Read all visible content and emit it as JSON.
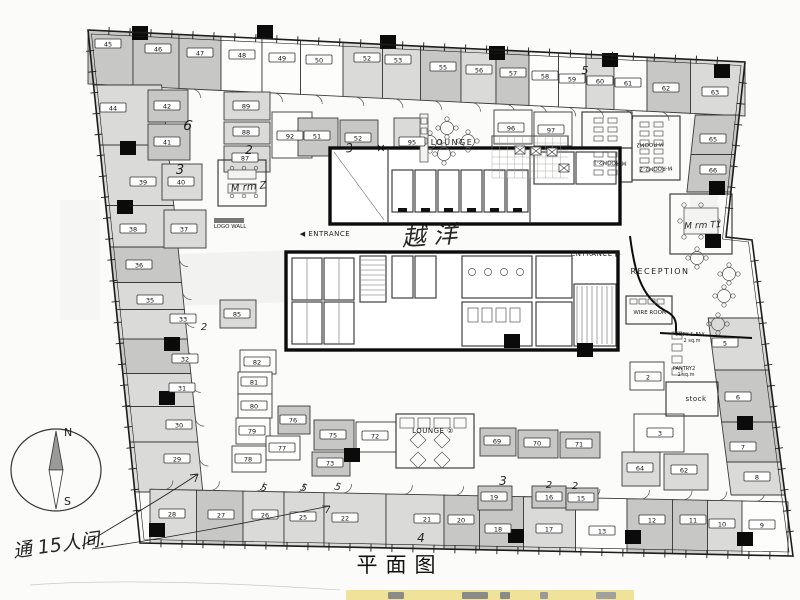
{
  "title": {
    "text": "平面图"
  },
  "compass": {
    "north": "N",
    "south": "S"
  },
  "colors": {
    "paper": "#fbfbf9",
    "wall": "#3a3a3a",
    "ink": "#1c1c1c",
    "gray_light": "#dadad8",
    "gray_mid": "#c7c7c5",
    "gray_dark": "#ababa9",
    "highlight": "#f0df8e"
  },
  "labels": [
    {
      "t": "LOUNGE",
      "x": 452,
      "y": 145,
      "s": 8,
      "ls": 1.5
    },
    {
      "t": "LOUNGE ②",
      "x": 433,
      "y": 433,
      "s": 7,
      "ls": 0.5
    },
    {
      "t": "RECEPTION",
      "x": 660,
      "y": 274,
      "s": 8,
      "ls": 1.5
    },
    {
      "t": "◀ ENTRANCE",
      "x": 325,
      "y": 236,
      "s": 7,
      "ls": 0.5
    },
    {
      "t": "ENTRANCE ▶",
      "x": 596,
      "y": 256,
      "s": 7,
      "ls": 0.5
    },
    {
      "t": "LOGO WALL",
      "x": 230,
      "y": 228,
      "s": 5.5,
      "ls": 0
    },
    {
      "t": "WIRE ROOM",
      "x": 650,
      "y": 314,
      "s": 5.5,
      "ls": 0
    },
    {
      "t": "COPY & FAX",
      "x": 690,
      "y": 336,
      "s": 5,
      "ls": 0
    },
    {
      "t": "2 sq.m",
      "x": 692,
      "y": 342,
      "s": 5,
      "ls": 0
    },
    {
      "t": "PANTRY2",
      "x": 684,
      "y": 370,
      "s": 5,
      "ls": 0
    },
    {
      "t": "1 sq.m",
      "x": 686,
      "y": 376,
      "s": 5,
      "ls": 0
    },
    {
      "t": "stock",
      "x": 696,
      "y": 401,
      "s": 7,
      "ls": 0.5
    },
    {
      "t": "M-ROOM2",
      "x": 650,
      "y": 143,
      "s": 5.5,
      "r": 178
    },
    {
      "t": "M-ROOM2-1",
      "x": 610,
      "y": 161,
      "s": 5.5,
      "r": 182
    },
    {
      "t": "M-ROOM2-2",
      "x": 656,
      "y": 167,
      "s": 5.5,
      "r": 178
    }
  ],
  "handwritten": [
    {
      "t": "越 洋",
      "x": 430,
      "y": 244,
      "s": 24,
      "r": -4
    },
    {
      "t": "M rm Z",
      "x": 249,
      "y": 190,
      "s": 10,
      "r": -6
    },
    {
      "t": "M rm T1",
      "x": 703,
      "y": 228,
      "s": 9,
      "r": -3
    },
    {
      "t": "通 15人间.",
      "x": 60,
      "y": 551,
      "s": 19,
      "r": -8
    },
    {
      "t": "6",
      "x": 187,
      "y": 130,
      "s": 14,
      "r": 10
    },
    {
      "t": "3",
      "x": 180,
      "y": 174,
      "s": 13,
      "r": 0
    },
    {
      "t": "2",
      "x": 249,
      "y": 154,
      "s": 12,
      "r": 0
    },
    {
      "t": "3",
      "x": 350,
      "y": 152,
      "s": 12,
      "r": -8
    },
    {
      "t": "✕",
      "x": 381,
      "y": 152,
      "s": 11,
      "r": 0
    },
    {
      "t": "5",
      "x": 585,
      "y": 74,
      "s": 11,
      "r": 0
    },
    {
      "t": "3",
      "x": 503,
      "y": 485,
      "s": 12,
      "r": 0
    },
    {
      "t": "2",
      "x": 549,
      "y": 488,
      "s": 10,
      "r": 0
    },
    {
      "t": "2",
      "x": 575,
      "y": 489,
      "s": 10,
      "r": 0
    },
    {
      "t": "4",
      "x": 421,
      "y": 542,
      "s": 12,
      "r": 0
    },
    {
      "t": "5",
      "x": 263,
      "y": 491,
      "s": 10,
      "r": 15
    },
    {
      "t": "5",
      "x": 303,
      "y": 491,
      "s": 10,
      "r": 15
    },
    {
      "t": "5",
      "x": 337,
      "y": 490,
      "s": 10,
      "r": 15
    },
    {
      "t": "2",
      "x": 204,
      "y": 330,
      "s": 10,
      "r": 0
    }
  ],
  "rooms": [
    {
      "n": "45",
      "x": 108,
      "y": 44,
      "f": "m",
      "band": "top"
    },
    {
      "n": "46",
      "x": 158,
      "y": 49,
      "f": "m",
      "band": "top"
    },
    {
      "n": "47",
      "x": 200,
      "y": 53,
      "f": "m",
      "band": "top"
    },
    {
      "n": "48",
      "x": 242,
      "y": 55,
      "f": "w",
      "band": "top"
    },
    {
      "n": "49",
      "x": 282,
      "y": 58,
      "f": "w",
      "band": "top"
    },
    {
      "n": "50",
      "x": 319,
      "y": 60,
      "f": "w",
      "band": "top"
    },
    {
      "n": "52",
      "x": 367,
      "y": 58,
      "f": "l",
      "band": "top"
    },
    {
      "n": "53",
      "x": 398,
      "y": 60,
      "f": "l",
      "band": "top"
    },
    {
      "n": "55",
      "x": 443,
      "y": 67,
      "f": "m",
      "band": "top"
    },
    {
      "n": "56",
      "x": 479,
      "y": 70,
      "f": "l",
      "band": "top"
    },
    {
      "n": "57",
      "x": 513,
      "y": 73,
      "f": "m",
      "band": "top"
    },
    {
      "n": "58",
      "x": 545,
      "y": 76,
      "f": "w",
      "band": "top"
    },
    {
      "n": "59",
      "x": 572,
      "y": 79,
      "f": "w",
      "band": "top"
    },
    {
      "n": "60",
      "x": 600,
      "y": 81,
      "f": "l",
      "band": "top"
    },
    {
      "n": "61",
      "x": 628,
      "y": 83,
      "f": "w",
      "band": "top"
    },
    {
      "n": "62",
      "x": 666,
      "y": 88,
      "f": "m",
      "band": "top"
    },
    {
      "n": "63",
      "x": 715,
      "y": 92,
      "f": "l",
      "band": "top"
    },
    {
      "n": "44",
      "x": 113,
      "y": 108,
      "f": "l",
      "band": "left"
    },
    {
      "n": "39",
      "x": 143,
      "y": 182,
      "f": "l",
      "band": "left"
    },
    {
      "n": "38",
      "x": 133,
      "y": 229,
      "f": "l",
      "band": "left"
    },
    {
      "n": "36",
      "x": 139,
      "y": 265,
      "f": "m",
      "band": "left"
    },
    {
      "n": "35",
      "x": 150,
      "y": 300,
      "f": "l",
      "band": "left"
    },
    {
      "n": "33",
      "x": 183,
      "y": 319,
      "f": "l",
      "band": "left"
    },
    {
      "n": "32",
      "x": 185,
      "y": 359,
      "f": "m",
      "band": "left"
    },
    {
      "n": "31",
      "x": 182,
      "y": 388,
      "f": "l",
      "band": "left"
    },
    {
      "n": "30",
      "x": 179,
      "y": 425,
      "f": "l",
      "band": "left"
    },
    {
      "n": "29",
      "x": 177,
      "y": 459,
      "f": "l",
      "band": "left"
    },
    {
      "n": "28",
      "x": 172,
      "y": 514,
      "f": "l",
      "band": "bottom"
    },
    {
      "n": "27",
      "x": 221,
      "y": 515,
      "f": "m",
      "band": "bottom"
    },
    {
      "n": "26",
      "x": 265,
      "y": 515,
      "f": "l",
      "band": "bottom"
    },
    {
      "n": "25",
      "x": 303,
      "y": 517,
      "f": "l",
      "band": "bottom"
    },
    {
      "n": "22",
      "x": 345,
      "y": 518,
      "f": "l",
      "band": "bottom"
    },
    {
      "n": "21",
      "x": 427,
      "y": 519,
      "f": "l",
      "band": "bottom"
    },
    {
      "n": "20",
      "x": 461,
      "y": 520,
      "f": "m",
      "band": "bottom"
    },
    {
      "n": "18",
      "x": 498,
      "y": 529,
      "f": "m",
      "band": "bottom"
    },
    {
      "n": "17",
      "x": 549,
      "y": 529,
      "f": "l",
      "band": "bottom"
    },
    {
      "n": "13",
      "x": 602,
      "y": 531,
      "f": "w",
      "band": "bottom"
    },
    {
      "n": "12",
      "x": 652,
      "y": 520,
      "f": "m",
      "band": "bottom"
    },
    {
      "n": "11",
      "x": 693,
      "y": 520,
      "f": "m",
      "band": "bottom"
    },
    {
      "n": "10",
      "x": 722,
      "y": 524,
      "f": "l",
      "band": "bottom"
    },
    {
      "n": "9",
      "x": 762,
      "y": 525,
      "f": "w",
      "band": "bottom"
    },
    {
      "n": "65",
      "x": 713,
      "y": 139,
      "f": "m",
      "band": "right1"
    },
    {
      "n": "66",
      "x": 713,
      "y": 170,
      "f": "m",
      "band": "right1"
    },
    {
      "n": "5",
      "x": 725,
      "y": 343,
      "f": "l",
      "band": "right2"
    },
    {
      "n": "6",
      "x": 738,
      "y": 397,
      "f": "m",
      "band": "right2"
    },
    {
      "n": "7",
      "x": 743,
      "y": 447,
      "f": "m",
      "band": "right2"
    },
    {
      "n": "8",
      "x": 757,
      "y": 477,
      "f": "l",
      "band": "right2"
    },
    {
      "n": "42",
      "x": 167,
      "y": 106,
      "f": "m",
      "rect": [
        148,
        90,
        40,
        32
      ]
    },
    {
      "n": "41",
      "x": 167,
      "y": 142,
      "f": "m",
      "rect": [
        148,
        124,
        42,
        36
      ]
    },
    {
      "n": "40",
      "x": 181,
      "y": 182,
      "f": "l",
      "rect": [
        162,
        164,
        40,
        36
      ]
    },
    {
      "n": "37",
      "x": 184,
      "y": 229,
      "f": "l",
      "rect": [
        164,
        210,
        42,
        38
      ]
    },
    {
      "n": "89",
      "x": 246,
      "y": 106,
      "f": "l",
      "rect": [
        224,
        92,
        46,
        28
      ]
    },
    {
      "n": "88",
      "x": 246,
      "y": 132,
      "f": "l",
      "rect": [
        224,
        122,
        46,
        22
      ]
    },
    {
      "n": "87",
      "x": 245,
      "y": 158,
      "f": "l",
      "rect": [
        224,
        146,
        46,
        26
      ]
    },
    {
      "n": "92",
      "x": 290,
      "y": 136,
      "f": "w",
      "rect": [
        272,
        112,
        40,
        46
      ]
    },
    {
      "n": "51",
      "x": 317,
      "y": 136,
      "f": "m",
      "rect": [
        298,
        118,
        40,
        38
      ]
    },
    {
      "n": "52",
      "x": 358,
      "y": 138,
      "f": "m",
      "rect": [
        340,
        120,
        38,
        38
      ]
    },
    {
      "n": "95",
      "x": 412,
      "y": 142,
      "f": "l",
      "rect": [
        394,
        118,
        32,
        46
      ]
    },
    {
      "n": "96",
      "x": 511,
      "y": 128,
      "f": "w",
      "rect": [
        494,
        110,
        38,
        34
      ]
    },
    {
      "n": "97",
      "x": 551,
      "y": 130,
      "f": "w",
      "rect": [
        534,
        112,
        38,
        34
      ]
    },
    {
      "n": "85",
      "x": 237,
      "y": 314,
      "f": "l",
      "rect": [
        220,
        300,
        36,
        28
      ]
    },
    {
      "n": "82",
      "x": 257,
      "y": 362,
      "f": "w",
      "rect": [
        240,
        350,
        36,
        24
      ]
    },
    {
      "n": "81",
      "x": 254,
      "y": 382,
      "f": "w",
      "rect": [
        238,
        372,
        34,
        22
      ]
    },
    {
      "n": "80",
      "x": 254,
      "y": 406,
      "f": "w",
      "rect": [
        238,
        394,
        34,
        24
      ]
    },
    {
      "n": "79",
      "x": 252,
      "y": 431,
      "f": "w",
      "rect": [
        236,
        418,
        34,
        26
      ]
    },
    {
      "n": "78",
      "x": 248,
      "y": 459,
      "f": "w",
      "rect": [
        232,
        446,
        34,
        26
      ]
    },
    {
      "n": "77",
      "x": 282,
      "y": 448,
      "f": "w",
      "rect": [
        266,
        436,
        34,
        24
      ]
    },
    {
      "n": "76",
      "x": 293,
      "y": 420,
      "f": "m",
      "rect": [
        278,
        406,
        32,
        28
      ]
    },
    {
      "n": "75",
      "x": 333,
      "y": 435,
      "f": "m",
      "rect": [
        314,
        420,
        40,
        30
      ]
    },
    {
      "n": "73",
      "x": 330,
      "y": 463,
      "f": "m",
      "rect": [
        312,
        452,
        38,
        24
      ]
    },
    {
      "n": "72",
      "x": 375,
      "y": 436,
      "f": "w",
      "rect": [
        356,
        422,
        40,
        30
      ]
    },
    {
      "n": "69",
      "x": 497,
      "y": 441,
      "f": "m",
      "rect": [
        480,
        428,
        36,
        28
      ]
    },
    {
      "n": "70",
      "x": 537,
      "y": 443,
      "f": "m",
      "rect": [
        518,
        430,
        40,
        28
      ]
    },
    {
      "n": "71",
      "x": 579,
      "y": 444,
      "f": "m",
      "rect": [
        560,
        432,
        40,
        26
      ]
    },
    {
      "n": "19",
      "x": 494,
      "y": 497,
      "f": "m",
      "rect": [
        478,
        486,
        34,
        24
      ]
    },
    {
      "n": "16",
      "x": 549,
      "y": 497,
      "f": "m",
      "rect": [
        532,
        486,
        34,
        22
      ]
    },
    {
      "n": "15",
      "x": 581,
      "y": 498,
      "f": "m",
      "rect": [
        566,
        488,
        32,
        22
      ]
    },
    {
      "n": "64",
      "x": 640,
      "y": 468,
      "f": "l",
      "rect": [
        622,
        452,
        38,
        34
      ]
    },
    {
      "n": "62",
      "x": 684,
      "y": 470,
      "f": "l",
      "rect": [
        664,
        454,
        44,
        36
      ]
    },
    {
      "n": "2",
      "x": 648,
      "y": 377,
      "f": "w",
      "rect": [
        630,
        362,
        34,
        28
      ]
    },
    {
      "n": "3",
      "x": 660,
      "y": 433,
      "f": "w",
      "rect": [
        634,
        414,
        50,
        38
      ]
    }
  ],
  "columns": [
    [
      140,
      33
    ],
    [
      265,
      32
    ],
    [
      388,
      42
    ],
    [
      497,
      53
    ],
    [
      610,
      60
    ],
    [
      722,
      71
    ],
    [
      717,
      188
    ],
    [
      713,
      241
    ],
    [
      128,
      148
    ],
    [
      125,
      207
    ],
    [
      172,
      344
    ],
    [
      167,
      398
    ],
    [
      157,
      530
    ],
    [
      516,
      536
    ],
    [
      633,
      537
    ],
    [
      745,
      539
    ],
    [
      745,
      423
    ],
    [
      585,
      350
    ],
    [
      352,
      455
    ],
    [
      512,
      341
    ]
  ]
}
